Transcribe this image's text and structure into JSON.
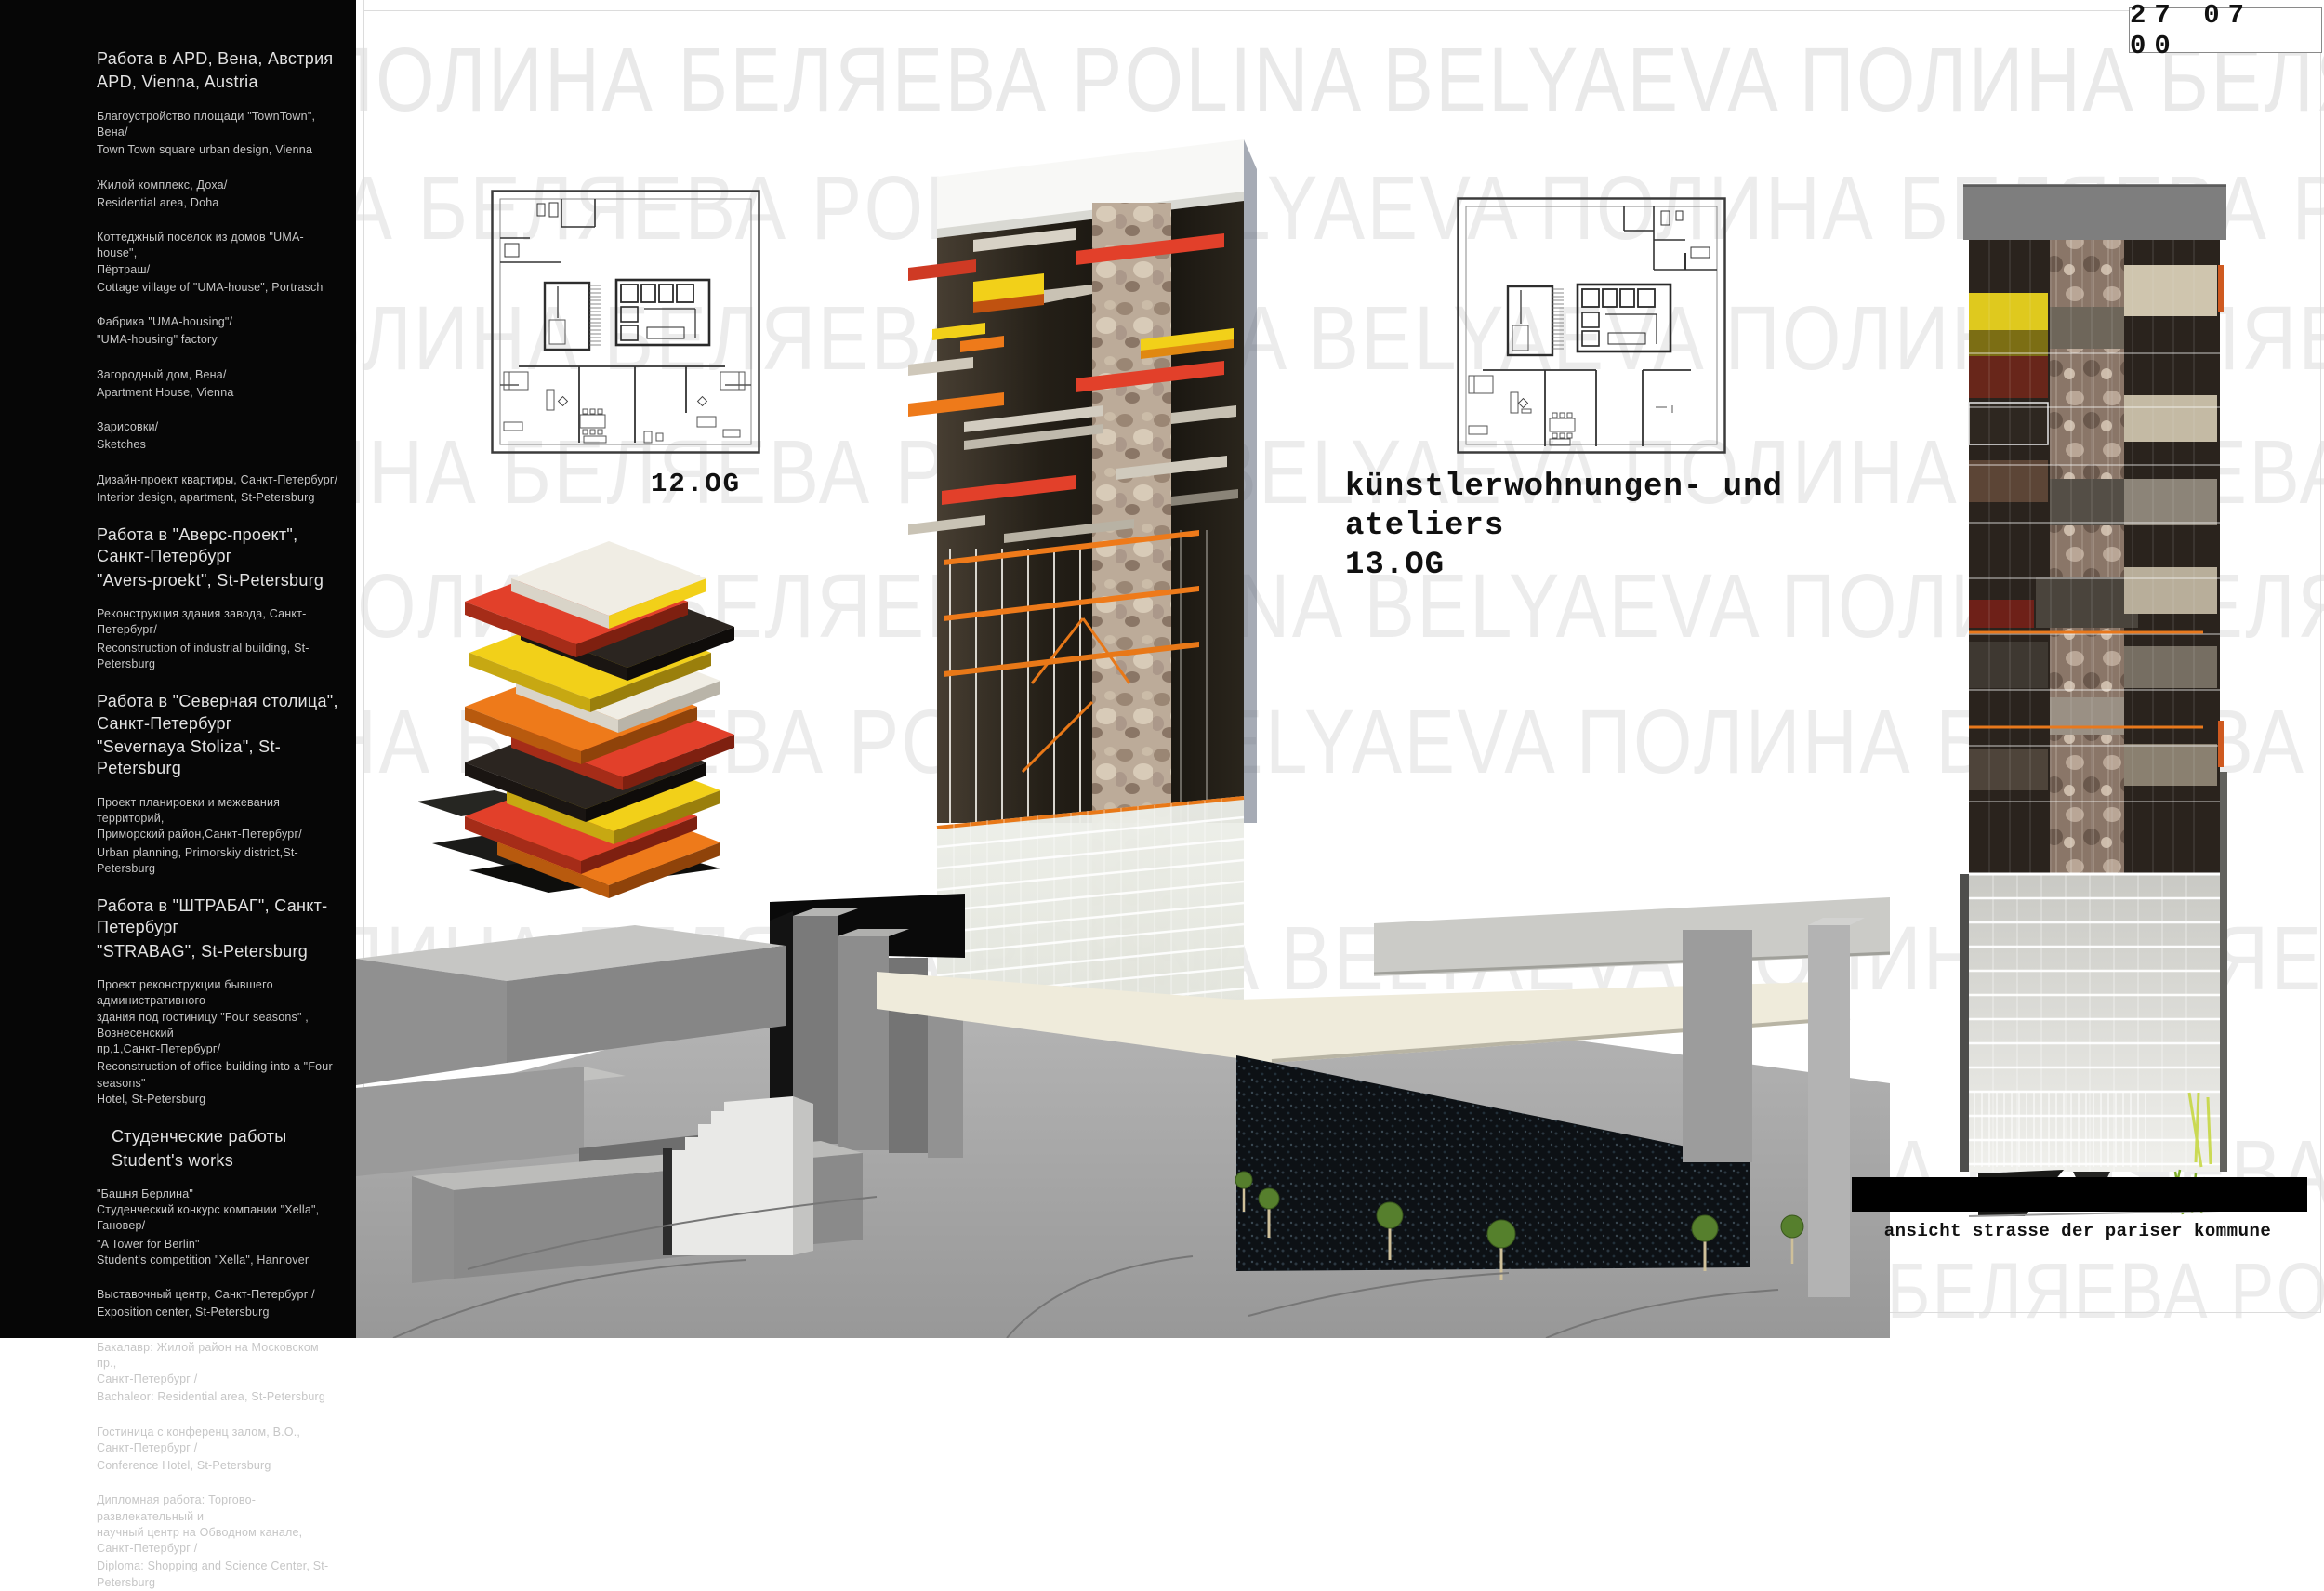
{
  "page": {
    "date_stamp": "27 07 00",
    "watermark_row": "ПОЛИНА БЕЛЯЕВА POLINA BELYAEVA ПОЛИНА БЕЛЯЕВА POLINA BELYAEVA ПОЛИНА БЕЛЯЕВА POLINA BELYAEVA"
  },
  "labels": {
    "plan_left": "12.OG",
    "atelier_line1": "künstlerwohnungen- und",
    "atelier_line2": "ateliers",
    "atelier_line3": "13.OG",
    "elevation_caption": "ansicht strasse der pariser kommune"
  },
  "colors": {
    "accent_red": "#e2402a",
    "accent_orange": "#ee7a1a",
    "accent_yellow": "#f2d019",
    "sidebar_bg": "#060606",
    "watermark_gray": "#ececec"
  },
  "sidebar": {
    "sections": [
      {
        "style": "header",
        "ru": "Работа в APD, Вена, Австрия",
        "en": "APD, Vienna, Austria"
      },
      {
        "style": "item",
        "ru": "Благоустройство площади \"TownTown\", Вена/",
        "en": "Town Town square urban design, Vienna"
      },
      {
        "style": "item",
        "ru": "Жилой комплекс, Доха/",
        "en": "Residential area, Doha"
      },
      {
        "style": "item",
        "ru": "Коттеджный поселок из домов \"UMA-house\",\nПёртраш/",
        "en": "Cottage village of \"UMA-house\", Portrasch"
      },
      {
        "style": "item",
        "ru": "Фабрика \"UMA-housing\"/",
        "en": "\"UMA-housing\" factory"
      },
      {
        "style": "item",
        "ru": "Загородный дом, Вена/",
        "en": "Apartment House, Vienna"
      },
      {
        "style": "item",
        "ru": "Зарисовки/",
        "en": "Sketches"
      },
      {
        "style": "item",
        "ru": "Дизайн-проект квартиры, Санкт-Петербург/",
        "en": "Interior design, apartment, St-Petersburg"
      },
      {
        "style": "header",
        "ru": "Работа в \"Аверс-проект\",\nСанкт-Петербург",
        "en": "\"Avers-proekt\", St-Petersburg"
      },
      {
        "style": "item",
        "ru": "Реконструкция здания завода, Санкт-Петербург/",
        "en": "Reconstruction of industrial building, St-Petersburg"
      },
      {
        "style": "header",
        "ru": "Работа в \"Северная столица\",\nСанкт-Петербург",
        "en": "\"Severnaya Stoliza\", St-Petersburg"
      },
      {
        "style": "item",
        "ru": "Проект планировки и межевания территорий,\nПриморский район,Санкт-Петербург/",
        "en": "Urban planning, Primorskiy district,St-Petersburg"
      },
      {
        "style": "header",
        "ru": "Работа в \"ШТРАБАГ\", Санкт-Петербург",
        "en": "\"STRABAG\", St-Petersburg"
      },
      {
        "style": "item",
        "ru": "Проект реконструкции бывшего административного\nздания под гостиницу \"Four seasons\" , Вознесенский\nпр,1,Санкт-Петербург/",
        "en": "Reconstruction of office building into a \"Four seasons\"\nHotel, St-Petersburg"
      },
      {
        "style": "header",
        "ru": "Студенческие работы",
        "en": "Student's works"
      },
      {
        "style": "item",
        "ru": "\"Башня Берлина\"\nСтуденческий конкурс компании \"Xella\", Гановер/",
        "en": "\"A Tower for Berlin\"\nStudent's competition \"Xella\", Hannover"
      },
      {
        "style": "item",
        "ru": "Выставочный центр, Санкт-Петербург /",
        "en": "Exposition center, St-Petersburg"
      },
      {
        "style": "item",
        "ru": "Бакалавр: Жилой район на Московском пр.,\nСанкт-Петербург /",
        "en": "Bachaleor: Residential area, St-Petersburg"
      },
      {
        "style": "item",
        "ru": "Гостиница с конференц залом, В.О.,\nСанкт-Петербург /",
        "en": "Conference Hotel, St-Petersburg"
      },
      {
        "style": "item",
        "ru": "Дипломная работа: Торгово-развлекательный и\nнаучный центр на Обводном канале,\nСанкт-Петербург /",
        "en": "Diploma: Shopping and Science Center, St-Petersburg"
      }
    ]
  }
}
